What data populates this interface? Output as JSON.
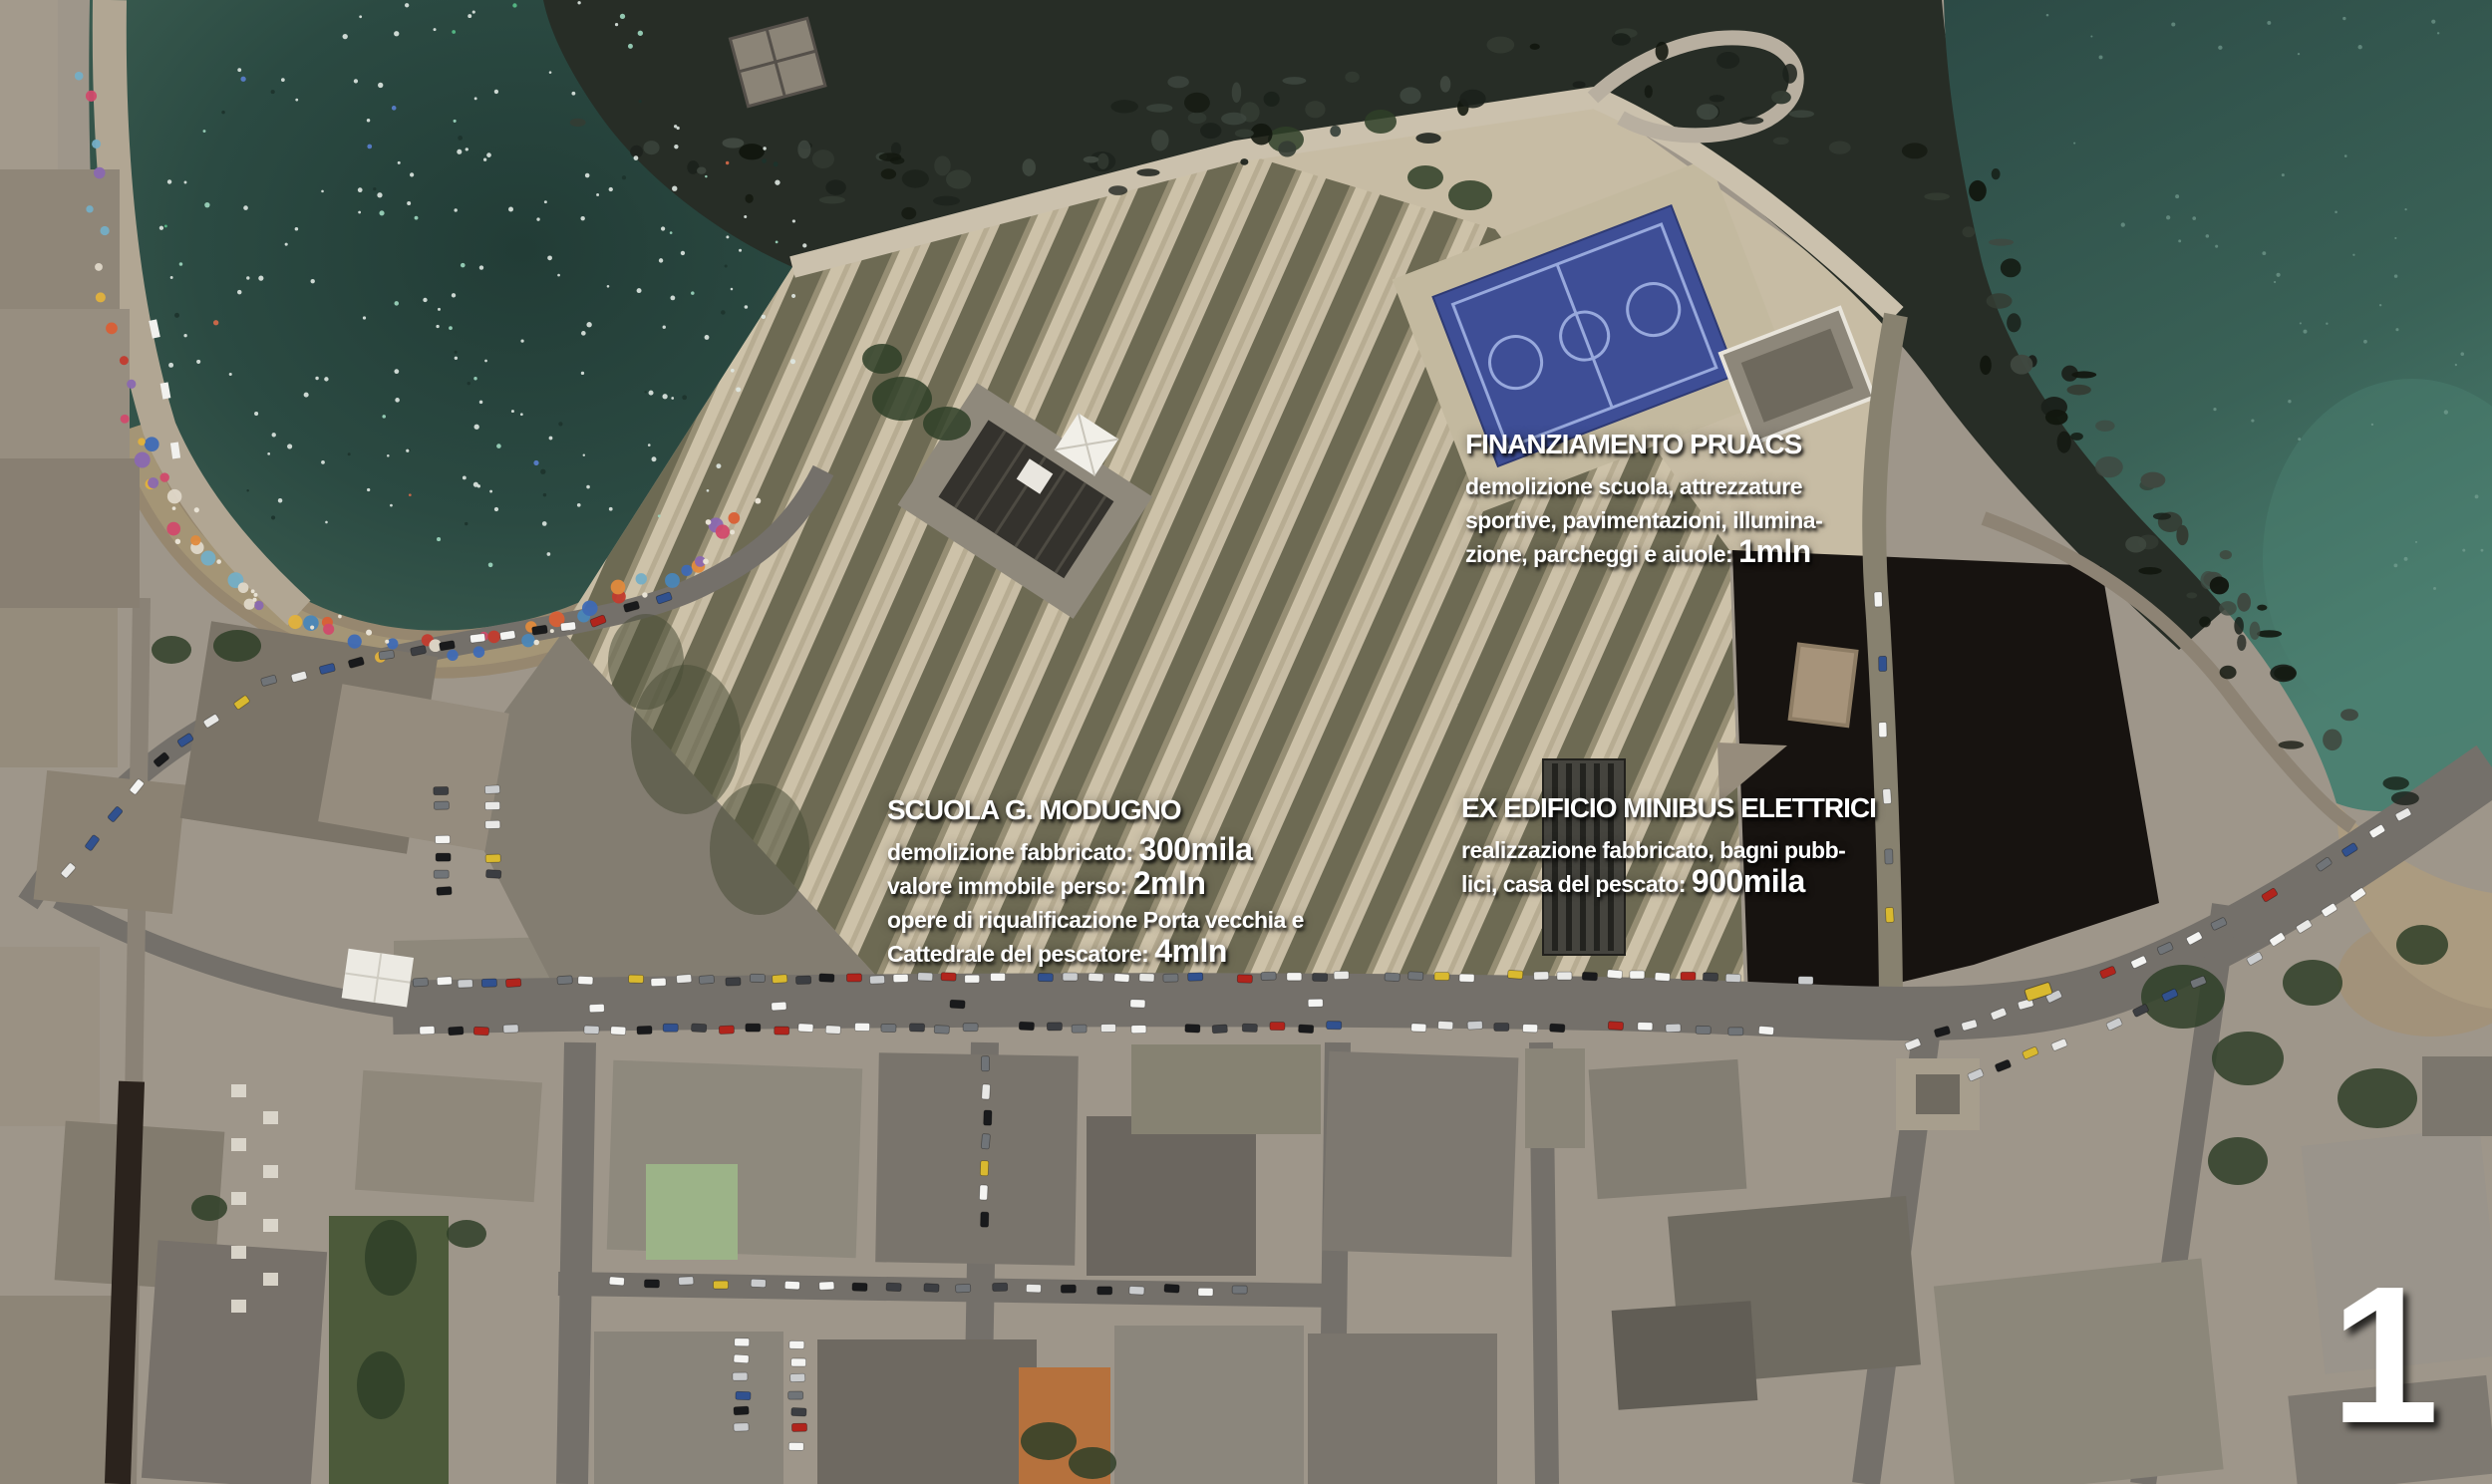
{
  "page_number": "1",
  "map_type": "satellite-aerial-view",
  "annotations": [
    {
      "id": "finanziamento-pruacs",
      "title": "FINANZIAMENTO PRUACS",
      "lines": [
        {
          "text": "demolizione scuola, attrezzature",
          "strong": ""
        },
        {
          "text": "sportive, pavimentazioni, illumina-",
          "strong": ""
        },
        {
          "text": "zione, parcheggi e aiuole: ",
          "strong": "1mln"
        }
      ]
    },
    {
      "id": "scuola-g-modugno",
      "title": "SCUOLA G. MODUGNO",
      "lines": [
        {
          "text": "demolizione fabbricato: ",
          "strong": "300mila"
        },
        {
          "text": "valore immobile perso: ",
          "strong": "2mln"
        },
        {
          "text": "opere di riqualificazione Porta vecchia e",
          "strong": ""
        },
        {
          "text": "Cattedrale del pescatore: ",
          "strong": "4mln"
        }
      ]
    },
    {
      "id": "ex-edificio-minibus-elettrici",
      "title": "EX EDIFICIO MINIBUS ELETTRICI",
      "lines": [
        {
          "text": "realizzazione fabbricato, bagni pubb-",
          "strong": ""
        },
        {
          "text": "lici, casa del pescato: ",
          "strong": "900mila"
        }
      ]
    }
  ],
  "colors": {
    "bay_water": "#2a463f",
    "open_sea": "#2f4f49",
    "shallow_sea": "#4c8071",
    "rocks": "#272d26",
    "sand_beach": "#96876f",
    "plaza_stone": "#c7bca4",
    "plaza_green_strip": "#56553f",
    "court_blue": "#3e4e96",
    "court_lines": "#97a8dc",
    "asphalt_road": "#74706a",
    "dark_lot": "#171310",
    "green_roof": "#9cb388",
    "orange_roof": "#b5713d",
    "text": "#ffffff"
  }
}
